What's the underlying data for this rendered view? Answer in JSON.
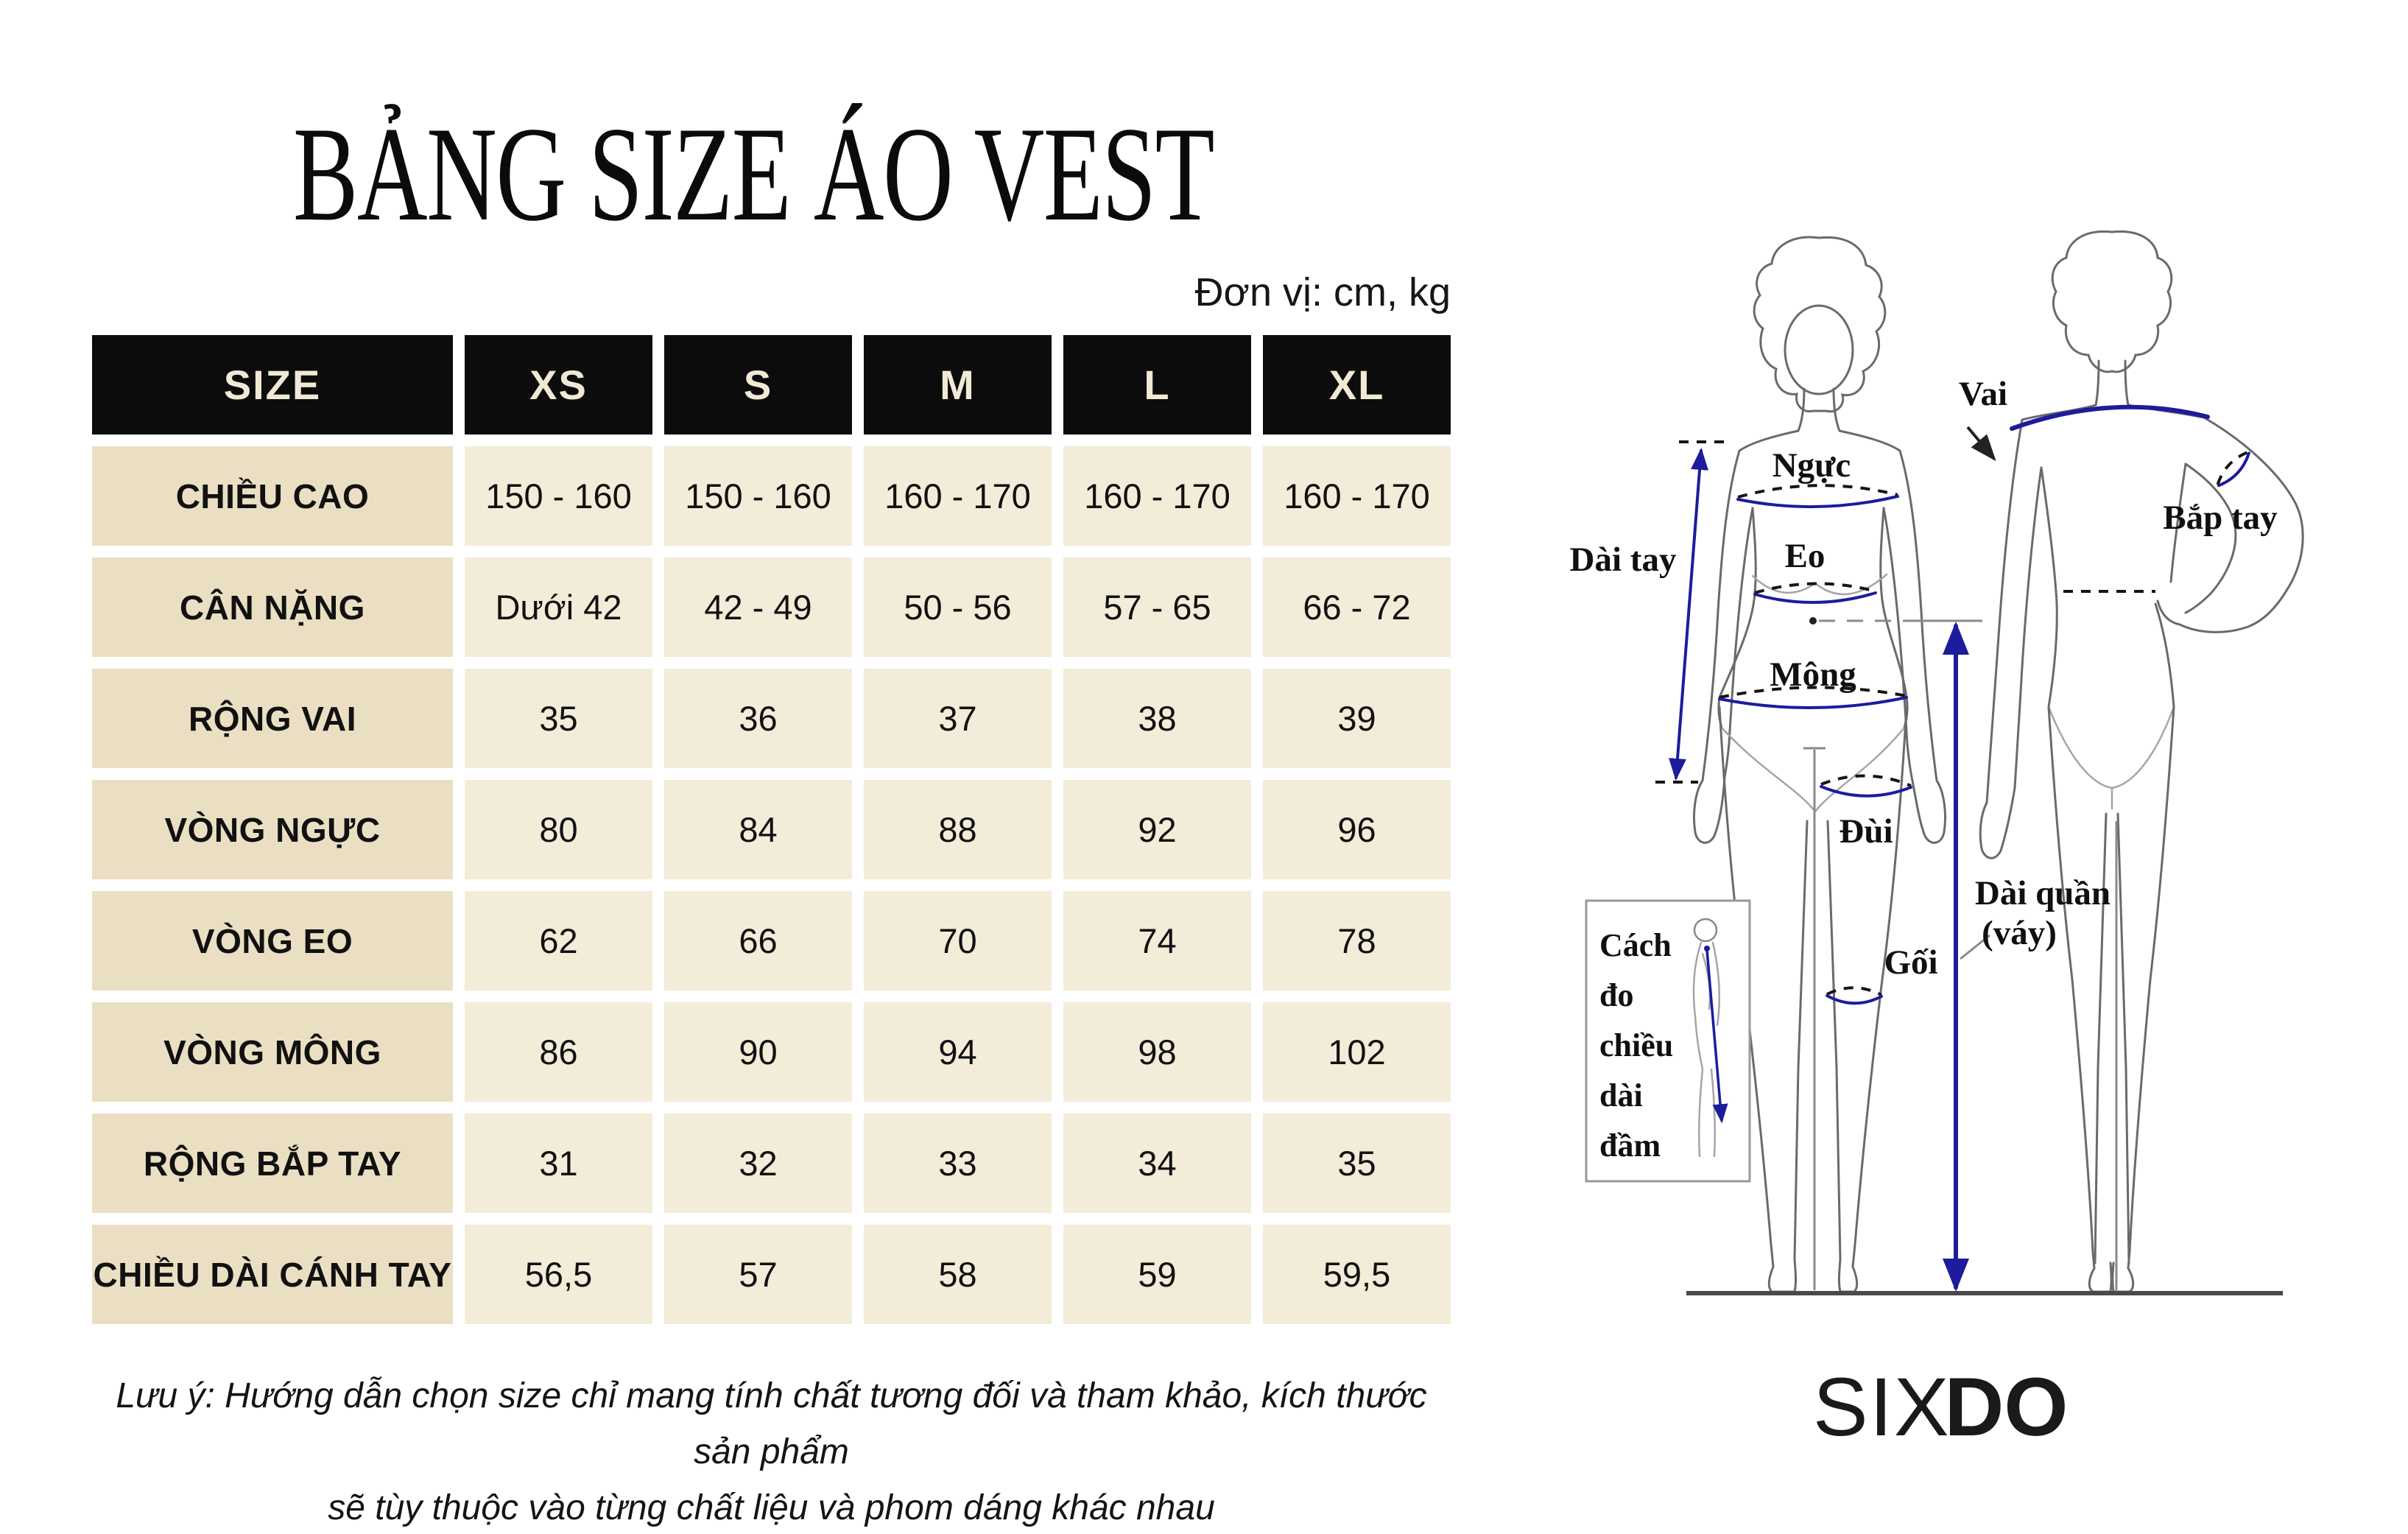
{
  "page": {
    "title": "BẢNG SIZE ÁO VEST",
    "unit_note": "Đơn vị: cm, kg"
  },
  "size_table": {
    "columns": [
      "SIZE",
      "XS",
      "S",
      "M",
      "L",
      "XL"
    ],
    "rows": [
      {
        "label": "CHIỀU CAO",
        "values": [
          "150 - 160",
          "150 - 160",
          "160 - 170",
          "160 - 170",
          "160 - 170"
        ]
      },
      {
        "label": "CÂN NẶNG",
        "values": [
          "Dưới 42",
          "42 - 49",
          "50 - 56",
          "57 - 65",
          "66 - 72"
        ]
      },
      {
        "label": "RỘNG VAI",
        "values": [
          "35",
          "36",
          "37",
          "38",
          "39"
        ]
      },
      {
        "label": "VÒNG NGỰC",
        "values": [
          "80",
          "84",
          "88",
          "92",
          "96"
        ]
      },
      {
        "label": "VÒNG EO",
        "values": [
          "62",
          "66",
          "70",
          "74",
          "78"
        ]
      },
      {
        "label": "VÒNG MÔNG",
        "values": [
          "86",
          "90",
          "94",
          "98",
          "102"
        ]
      },
      {
        "label": "RỘNG BẮP TAY",
        "values": [
          "31",
          "32",
          "33",
          "34",
          "35"
        ]
      },
      {
        "label": "CHIỀU DÀI CÁNH TAY",
        "values": [
          "56,5",
          "57",
          "58",
          "59",
          "59,5"
        ]
      }
    ]
  },
  "footnote": {
    "line1": "Lưu ý: Hướng dẫn chọn size chỉ mang tính chất tương đối và tham khảo, kích thước sản phẩm",
    "line2": "sẽ tùy thuộc vào từng chất liệu và phom dáng khác nhau"
  },
  "diagram": {
    "labels": {
      "dai_tay": "Dài tay",
      "nguc": "Ngực",
      "eo": "Eo",
      "mong": "Mông",
      "vai": "Vai",
      "bap_tay": "Bắp tay",
      "dui": "Đùi",
      "goi": "Gối",
      "dai_quan_line1": "Dài quần",
      "dai_quan_line2": "(váy)",
      "inset_line1": "Cách",
      "inset_line2": "đo",
      "inset_line3": "chiều",
      "inset_line4": "dài",
      "inset_line5": "đầm"
    }
  },
  "logo": {
    "part1": "SIX",
    "part2": "DO"
  },
  "colors": {
    "header_bg": "#0c0c0c",
    "header_text": "#f1e9d5",
    "label_cell_bg": "#ebdfc3",
    "value_cell_bg": "#f3ecd9",
    "measure_blue": "#1c1c9c",
    "outline_gray": "#6a6a6a"
  }
}
